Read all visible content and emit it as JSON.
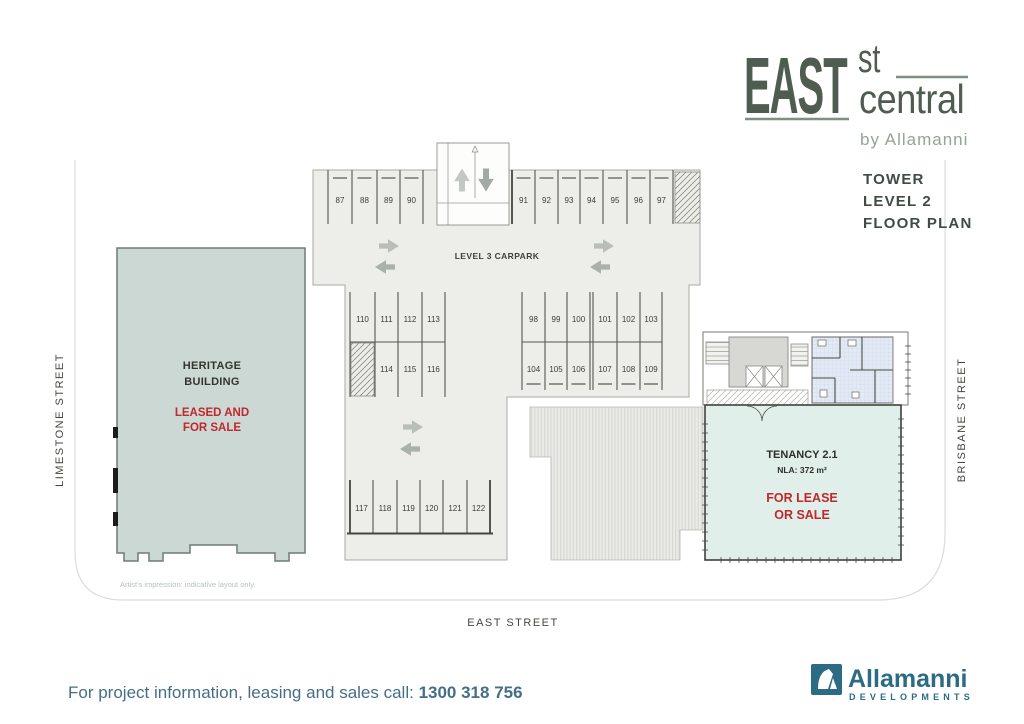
{
  "brand": {
    "name_primary": "EAST",
    "name_st": "st",
    "name_secondary": "central",
    "byline": "by Allamanni"
  },
  "plan_title": {
    "line1": "TOWER",
    "line2": "LEVEL 2",
    "line3": "FLOOR PLAN"
  },
  "streets": {
    "left": "LIMESTONE STREET",
    "right": "BRISBANE STREET",
    "bottom": "EAST STREET"
  },
  "carpark": {
    "area_label": "LEVEL 3 CARPARK",
    "bays": {
      "top_left": [
        "87",
        "88",
        "89",
        "90"
      ],
      "top_right": [
        "91",
        "92",
        "93",
        "94",
        "95",
        "96",
        "97"
      ],
      "mid_left_upper": [
        "110",
        "111",
        "112",
        "113"
      ],
      "mid_left_lower": [
        "114",
        "115",
        "116"
      ],
      "mid_right_upper": [
        "98",
        "99",
        "100",
        "101",
        "102",
        "103"
      ],
      "mid_right_lower": [
        "104",
        "105",
        "106",
        "107",
        "108",
        "109"
      ],
      "bottom_row": [
        "117",
        "118",
        "119",
        "120",
        "121",
        "122"
      ]
    }
  },
  "heritage_building": {
    "name_line1": "HERITAGE",
    "name_line2": "BUILDING",
    "status_line1": "LEASED AND",
    "status_line2": "FOR SALE"
  },
  "tenancy": {
    "name": "TENANCY 2.1",
    "nla": "NLA: 372 m²",
    "status_line1": "FOR LEASE",
    "status_line2": "OR SALE"
  },
  "disclaimer": "Artist's impression: indicative layout only.",
  "footer": {
    "label": "For project information, leasing and sales call: ",
    "phone": "1300 318 756"
  },
  "developer": {
    "name": "Allamanni",
    "division": "DEVELOPMENTS"
  },
  "colors": {
    "brand_green": "#4f5d50",
    "brand_green_light": "#95a497",
    "brand_rule": "#7f8f81",
    "accent_red": "#c0282e",
    "developer_teal": "#2b6c84",
    "footer_teal": "#456e87",
    "carpark_fill": "#edeee9",
    "heritage_fill": "#ccd8d4",
    "tenancy_fill": "#e0efe9",
    "bathroom_fill": "#e3eaf5"
  }
}
